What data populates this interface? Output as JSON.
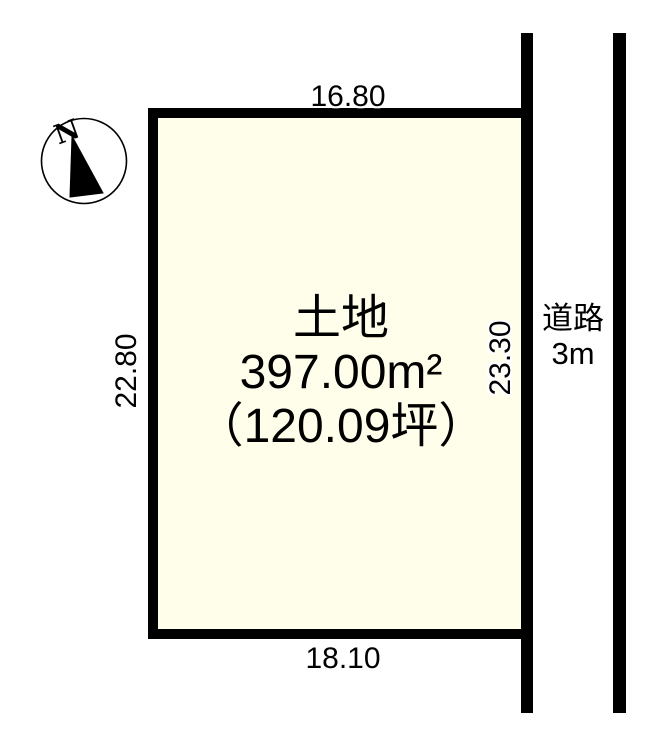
{
  "colors": {
    "line": "#000000",
    "plot_fill": "#fffeea",
    "text": "#000000",
    "halo": "#ffffff"
  },
  "compass": {
    "north_label": "N"
  },
  "parcel": {
    "title": "土地",
    "area_m2": "397.00m²",
    "area_tsubo": "（120.09坪）",
    "dimensions": {
      "top": "16.80",
      "bottom": "18.10",
      "left": "22.80",
      "right": "23.30"
    }
  },
  "road": {
    "name": "道路",
    "width": "3m"
  }
}
